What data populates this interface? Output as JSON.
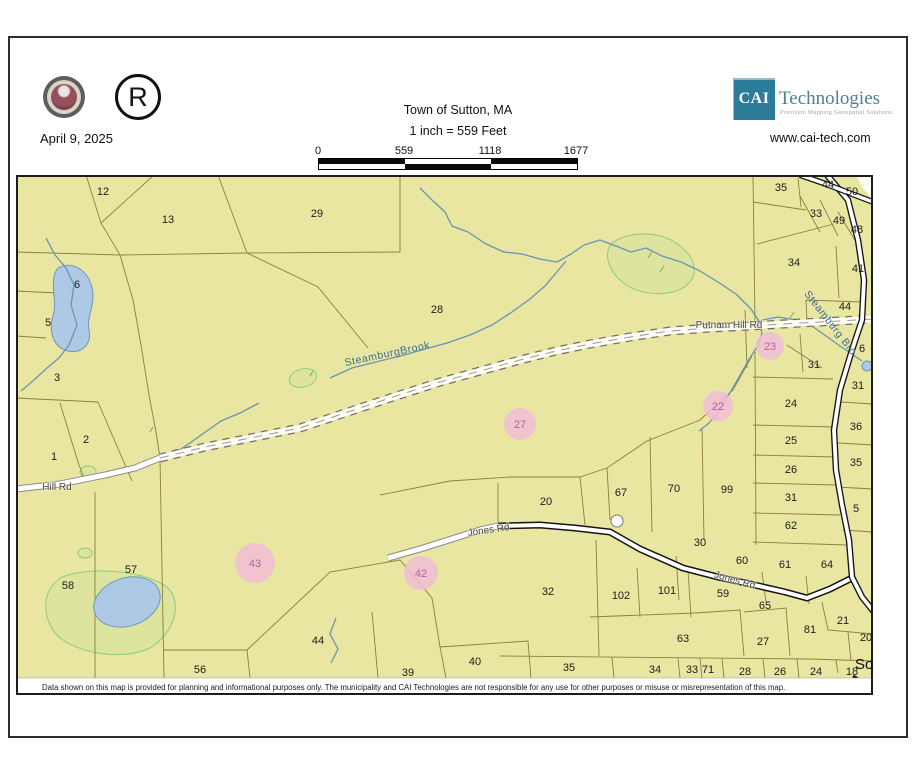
{
  "header": {
    "date": "April 9, 2025",
    "registered_symbol": "R",
    "title": "Town of Sutton, MA",
    "scale_text": "1 inch = 559 Feet",
    "scalebar_labels": [
      "0",
      "559",
      "1118",
      "1677"
    ],
    "logo": {
      "abbr": "CAI",
      "name": "Technologies",
      "tagline": "Precision Mapping Geospatial Solutions",
      "website": "www.cai-tech.com",
      "brand_color": "#2c7c99"
    }
  },
  "map": {
    "background_color": "#e8e6a0",
    "parcel_line_color": "#8c7f42",
    "water_color": "#adc9e6",
    "highlight_color": "#f1bcd9",
    "edge_label": "So",
    "disclaimer": "Data shown on this map is provided for planning and informational purposes only. The municipality and CAI Technologies are not responsible for any use for other purposes or misuse or misrepresentation of this map.",
    "parcel_labels": [
      {
        "t": "12",
        "x": 103,
        "y": 191
      },
      {
        "t": "13",
        "x": 168,
        "y": 219
      },
      {
        "t": "29",
        "x": 317,
        "y": 213
      },
      {
        "t": "28",
        "x": 437,
        "y": 309
      },
      {
        "t": "6",
        "x": 77,
        "y": 284
      },
      {
        "t": "5",
        "x": 48,
        "y": 322
      },
      {
        "t": "3",
        "x": 57,
        "y": 377
      },
      {
        "t": "2",
        "x": 86,
        "y": 439
      },
      {
        "t": "1",
        "x": 54,
        "y": 456
      },
      {
        "t": "35",
        "x": 781,
        "y": 187
      },
      {
        "t": "44",
        "x": 828,
        "y": 184
      },
      {
        "t": "50",
        "x": 852,
        "y": 191
      },
      {
        "t": "33",
        "x": 816,
        "y": 213
      },
      {
        "t": "49",
        "x": 839,
        "y": 220
      },
      {
        "t": "48",
        "x": 857,
        "y": 229
      },
      {
        "t": "34",
        "x": 794,
        "y": 262
      },
      {
        "t": "41",
        "x": 858,
        "y": 268
      },
      {
        "t": "44",
        "x": 845,
        "y": 306
      },
      {
        "t": "31",
        "x": 814,
        "y": 364
      },
      {
        "t": "6",
        "x": 862,
        "y": 348
      },
      {
        "t": "31",
        "x": 858,
        "y": 385
      },
      {
        "t": "24",
        "x": 791,
        "y": 403
      },
      {
        "t": "36",
        "x": 856,
        "y": 426
      },
      {
        "t": "25",
        "x": 791,
        "y": 440
      },
      {
        "t": "35",
        "x": 856,
        "y": 462
      },
      {
        "t": "26",
        "x": 791,
        "y": 469
      },
      {
        "t": "31",
        "x": 791,
        "y": 497
      },
      {
        "t": "5",
        "x": 856,
        "y": 508
      },
      {
        "t": "62",
        "x": 791,
        "y": 525
      },
      {
        "t": "20",
        "x": 546,
        "y": 501
      },
      {
        "t": "67",
        "x": 621,
        "y": 492
      },
      {
        "t": "70",
        "x": 674,
        "y": 488
      },
      {
        "t": "99",
        "x": 727,
        "y": 489
      },
      {
        "t": "30",
        "x": 700,
        "y": 542
      },
      {
        "t": "60",
        "x": 742,
        "y": 560
      },
      {
        "t": "61",
        "x": 785,
        "y": 564
      },
      {
        "t": "64",
        "x": 827,
        "y": 564
      },
      {
        "t": "57",
        "x": 131,
        "y": 569
      },
      {
        "t": "58",
        "x": 68,
        "y": 585
      },
      {
        "t": "32",
        "x": 548,
        "y": 591
      },
      {
        "t": "102",
        "x": 621,
        "y": 595
      },
      {
        "t": "101",
        "x": 667,
        "y": 590
      },
      {
        "t": "59",
        "x": 723,
        "y": 593
      },
      {
        "t": "65",
        "x": 765,
        "y": 605
      },
      {
        "t": "63",
        "x": 683,
        "y": 638
      },
      {
        "t": "27",
        "x": 763,
        "y": 641
      },
      {
        "t": "21",
        "x": 843,
        "y": 620
      },
      {
        "t": "81",
        "x": 810,
        "y": 629
      },
      {
        "t": "20",
        "x": 866,
        "y": 637
      },
      {
        "t": "44",
        "x": 318,
        "y": 640
      },
      {
        "t": "56",
        "x": 200,
        "y": 669
      },
      {
        "t": "39",
        "x": 408,
        "y": 672
      },
      {
        "t": "40",
        "x": 475,
        "y": 661
      },
      {
        "t": "35",
        "x": 569,
        "y": 667
      },
      {
        "t": "34",
        "x": 655,
        "y": 669
      },
      {
        "t": "33",
        "x": 692,
        "y": 669
      },
      {
        "t": "71",
        "x": 708,
        "y": 669
      },
      {
        "t": "28",
        "x": 745,
        "y": 671
      },
      {
        "t": "26",
        "x": 780,
        "y": 671
      },
      {
        "t": "24",
        "x": 816,
        "y": 671
      },
      {
        "t": "18",
        "x": 852,
        "y": 671
      }
    ],
    "highlight_circles": [
      {
        "t": "23",
        "x": 770,
        "y": 346,
        "r": 14
      },
      {
        "t": "22",
        "x": 718,
        "y": 406,
        "r": 15
      },
      {
        "t": "27",
        "x": 520,
        "y": 424,
        "r": 16
      },
      {
        "t": "42",
        "x": 421,
        "y": 573,
        "r": 17
      },
      {
        "t": "43",
        "x": 255,
        "y": 563,
        "r": 20
      }
    ],
    "road_labels": [
      {
        "t": "Putnam Hill Rd",
        "x": 729,
        "y": 328,
        "rot": 0
      },
      {
        "t": "Hill Rd",
        "x": 57,
        "y": 490,
        "rot": 0
      },
      {
        "t": "Jones Rd",
        "x": 489,
        "y": 533,
        "rot": -8
      },
      {
        "t": "Jones Rd",
        "x": 734,
        "y": 583,
        "rot": 16
      }
    ],
    "water_labels": [
      {
        "t": "SteamburgBrook",
        "x": 388,
        "y": 357,
        "rot": -12
      },
      {
        "t": "Steamburg Bro",
        "x": 828,
        "y": 325,
        "rot": 52
      }
    ]
  }
}
